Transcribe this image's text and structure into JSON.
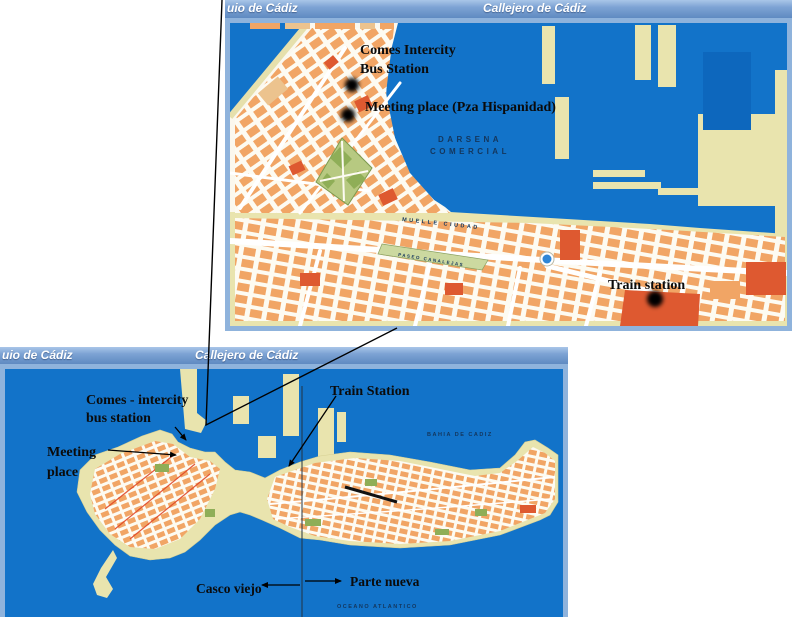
{
  "colors": {
    "water": "#1273c9",
    "dock_basin": "#0d67bd",
    "land_cream": "#e9e4ae",
    "street_bg": "#fbf8ee",
    "block_orange": "#f1a565",
    "block_tan": "#ecc38e",
    "accent_red": "#de5930",
    "park_green": "#b7c981",
    "dark_green": "#8fae57",
    "header_blue": "#6d97cc",
    "frame_blue": "#8fb3dc",
    "annotation_black": "#0b0b0b"
  },
  "inset_map": {
    "header": {
      "left_title": "uio de Cádiz",
      "right_title": "Callejero de Cádiz"
    },
    "labels": {
      "bus_station_line1": "Comes Intercity",
      "bus_station_line2": "Bus Station",
      "meeting_place": "Meeting place (Pza Hispanidad)",
      "train_station": "Train station",
      "darsena_line1": "DARSENA",
      "darsena_line2": "COMERCIAL",
      "muelle": "MUELLE CIUDAD",
      "canalejas": "PASEO CANALEJAS"
    }
  },
  "overview_map": {
    "header": {
      "left_title": "uio de Cádiz",
      "right_title": "Callejero de Cádiz"
    },
    "labels": {
      "bus_station_line1": "Comes - intercity",
      "bus_station_line2": "bus station",
      "meeting_line1": "Meeting",
      "meeting_line2": "place",
      "train_station": "Train Station",
      "casco_viejo": "Casco viejo",
      "parte_nueva": "Parte nueva",
      "bahia": "BAHIA DE CADIZ",
      "oceano": "OCEANO ATLANTICO"
    }
  }
}
